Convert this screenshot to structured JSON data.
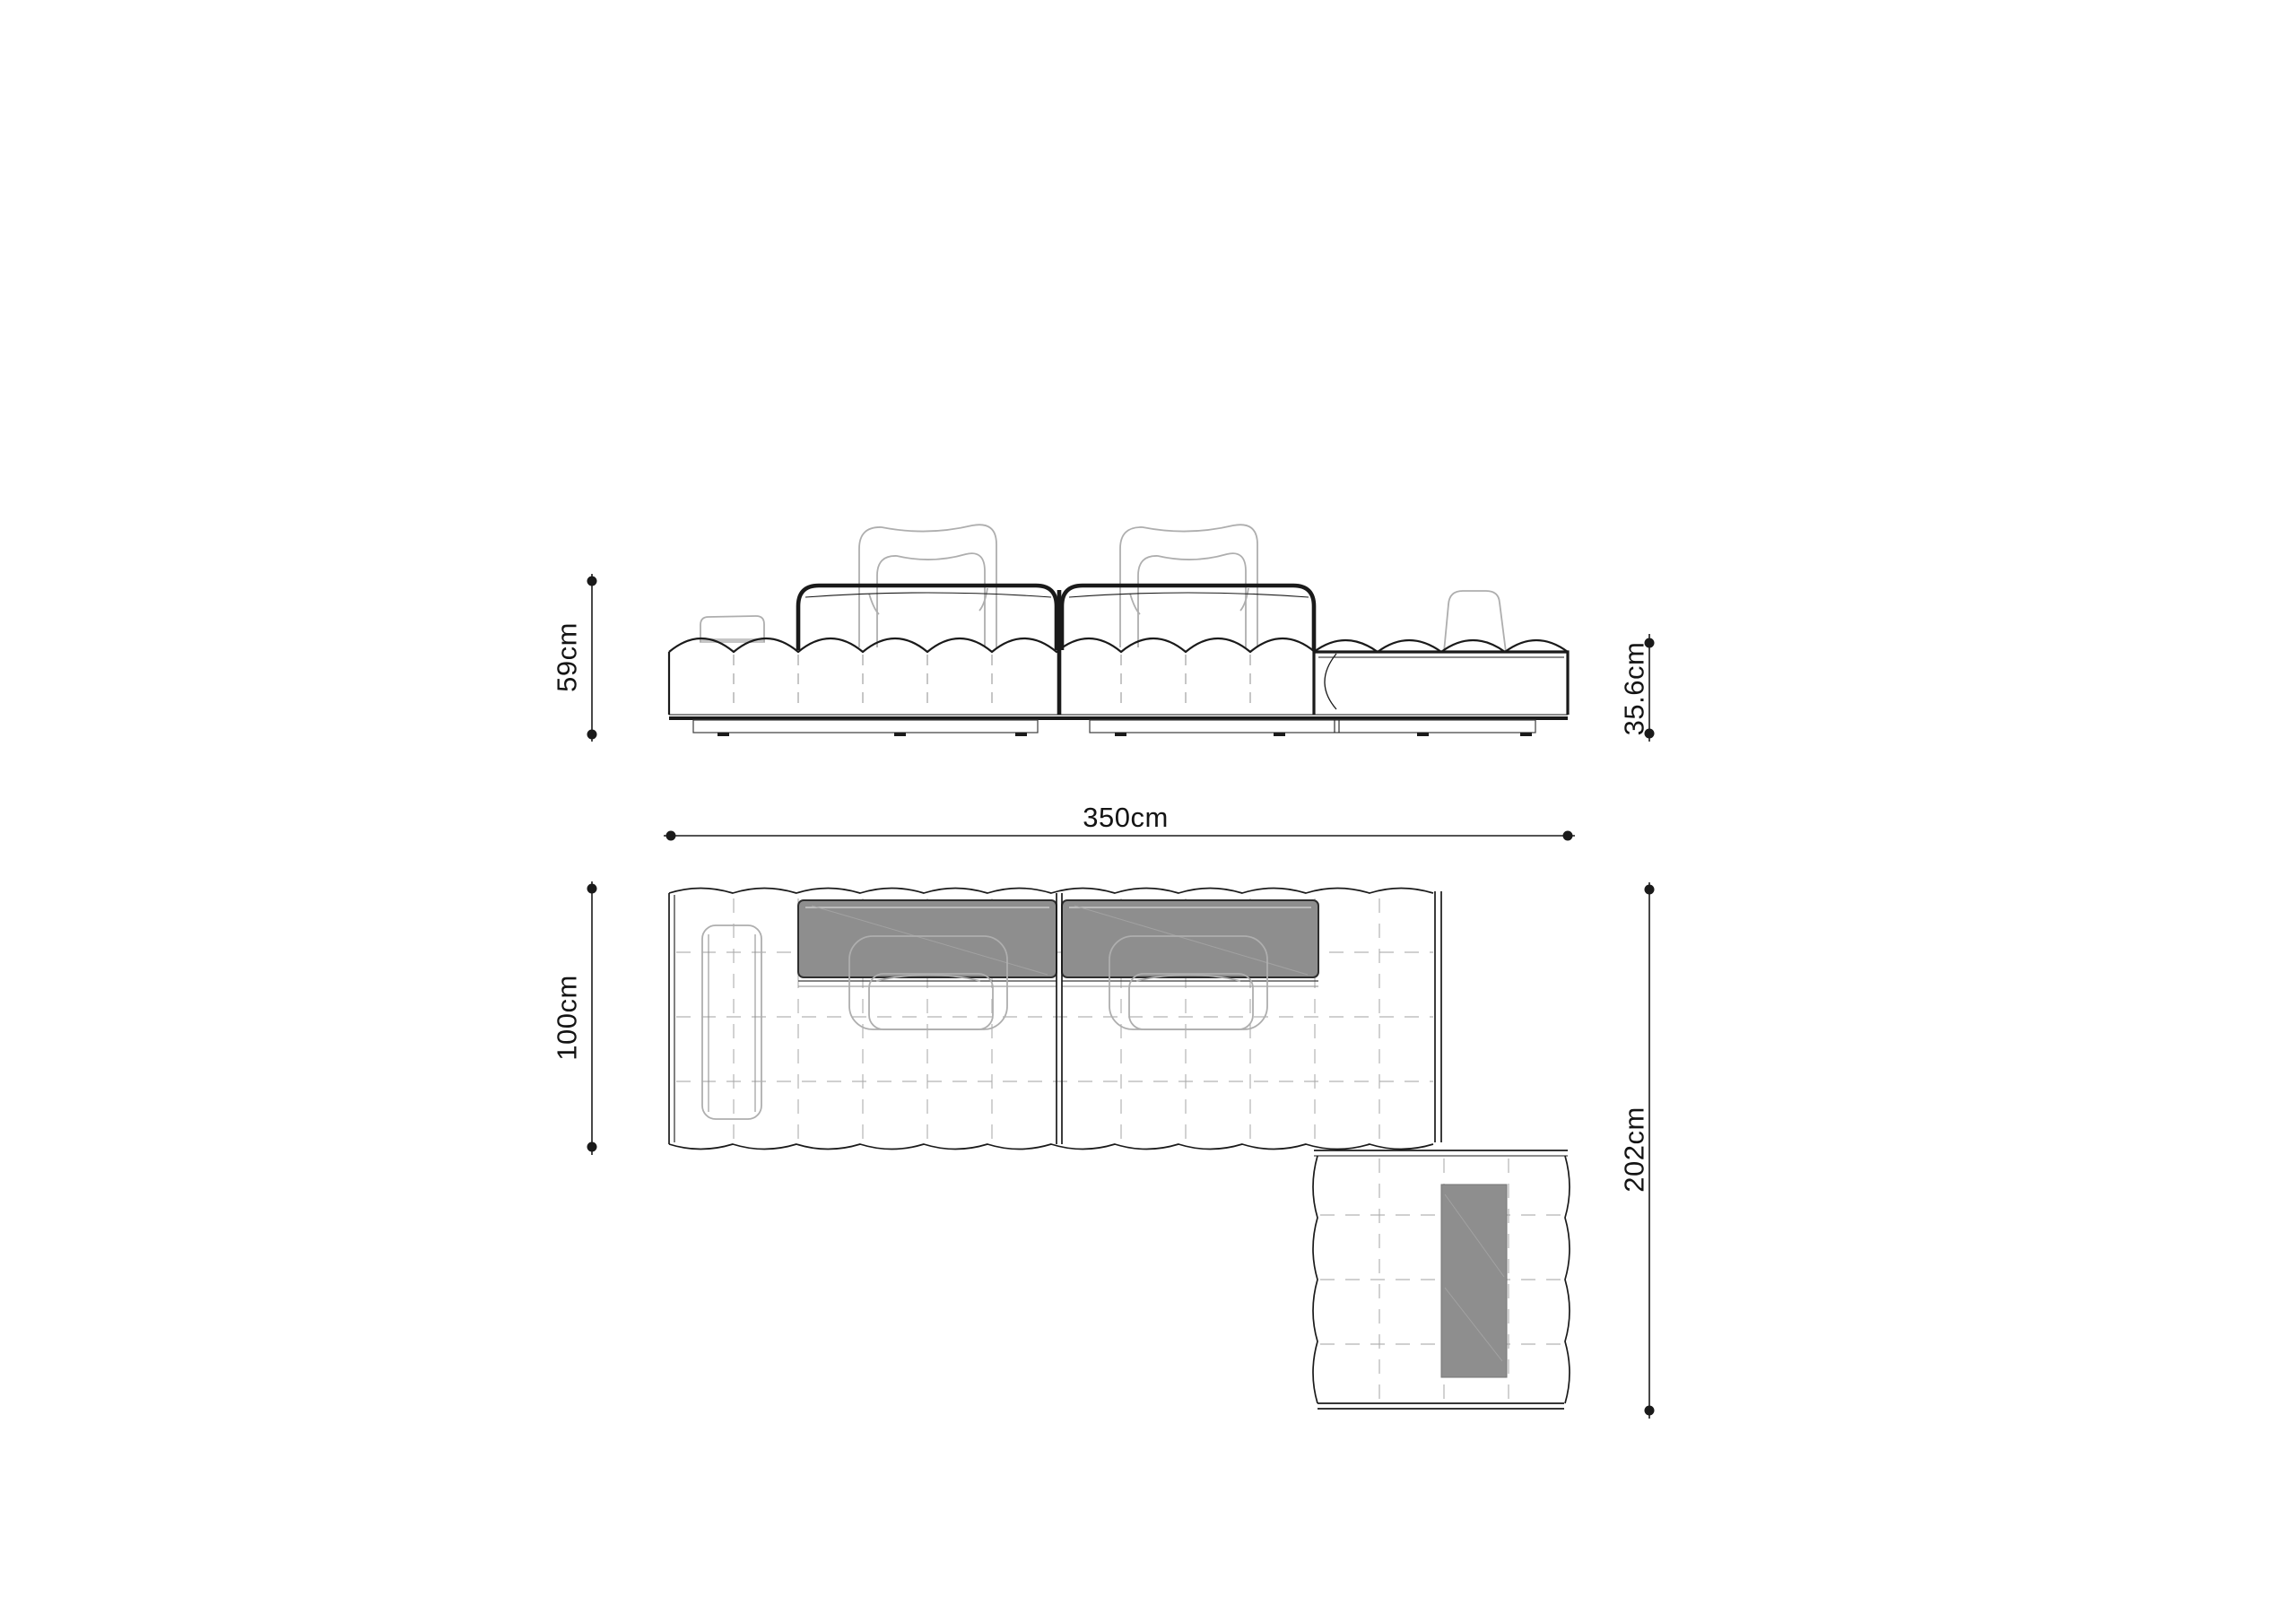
{
  "drawing": {
    "type": "furniture-technical-drawing",
    "subject": "modular-sofa-with-chaise",
    "dimensions": {
      "front_height": "59cm",
      "overall_width": "350cm",
      "chaise_height": "35.6cm",
      "seat_depth": "100cm",
      "overall_depth": "202cm"
    },
    "colors": {
      "background": "#ffffff",
      "line": "#1a1a1a",
      "ghost": "#aeaeae",
      "dash": "#a8a8a8",
      "band_fill": "#8e8e8e",
      "band_stroke": "#2f2f2f"
    }
  }
}
